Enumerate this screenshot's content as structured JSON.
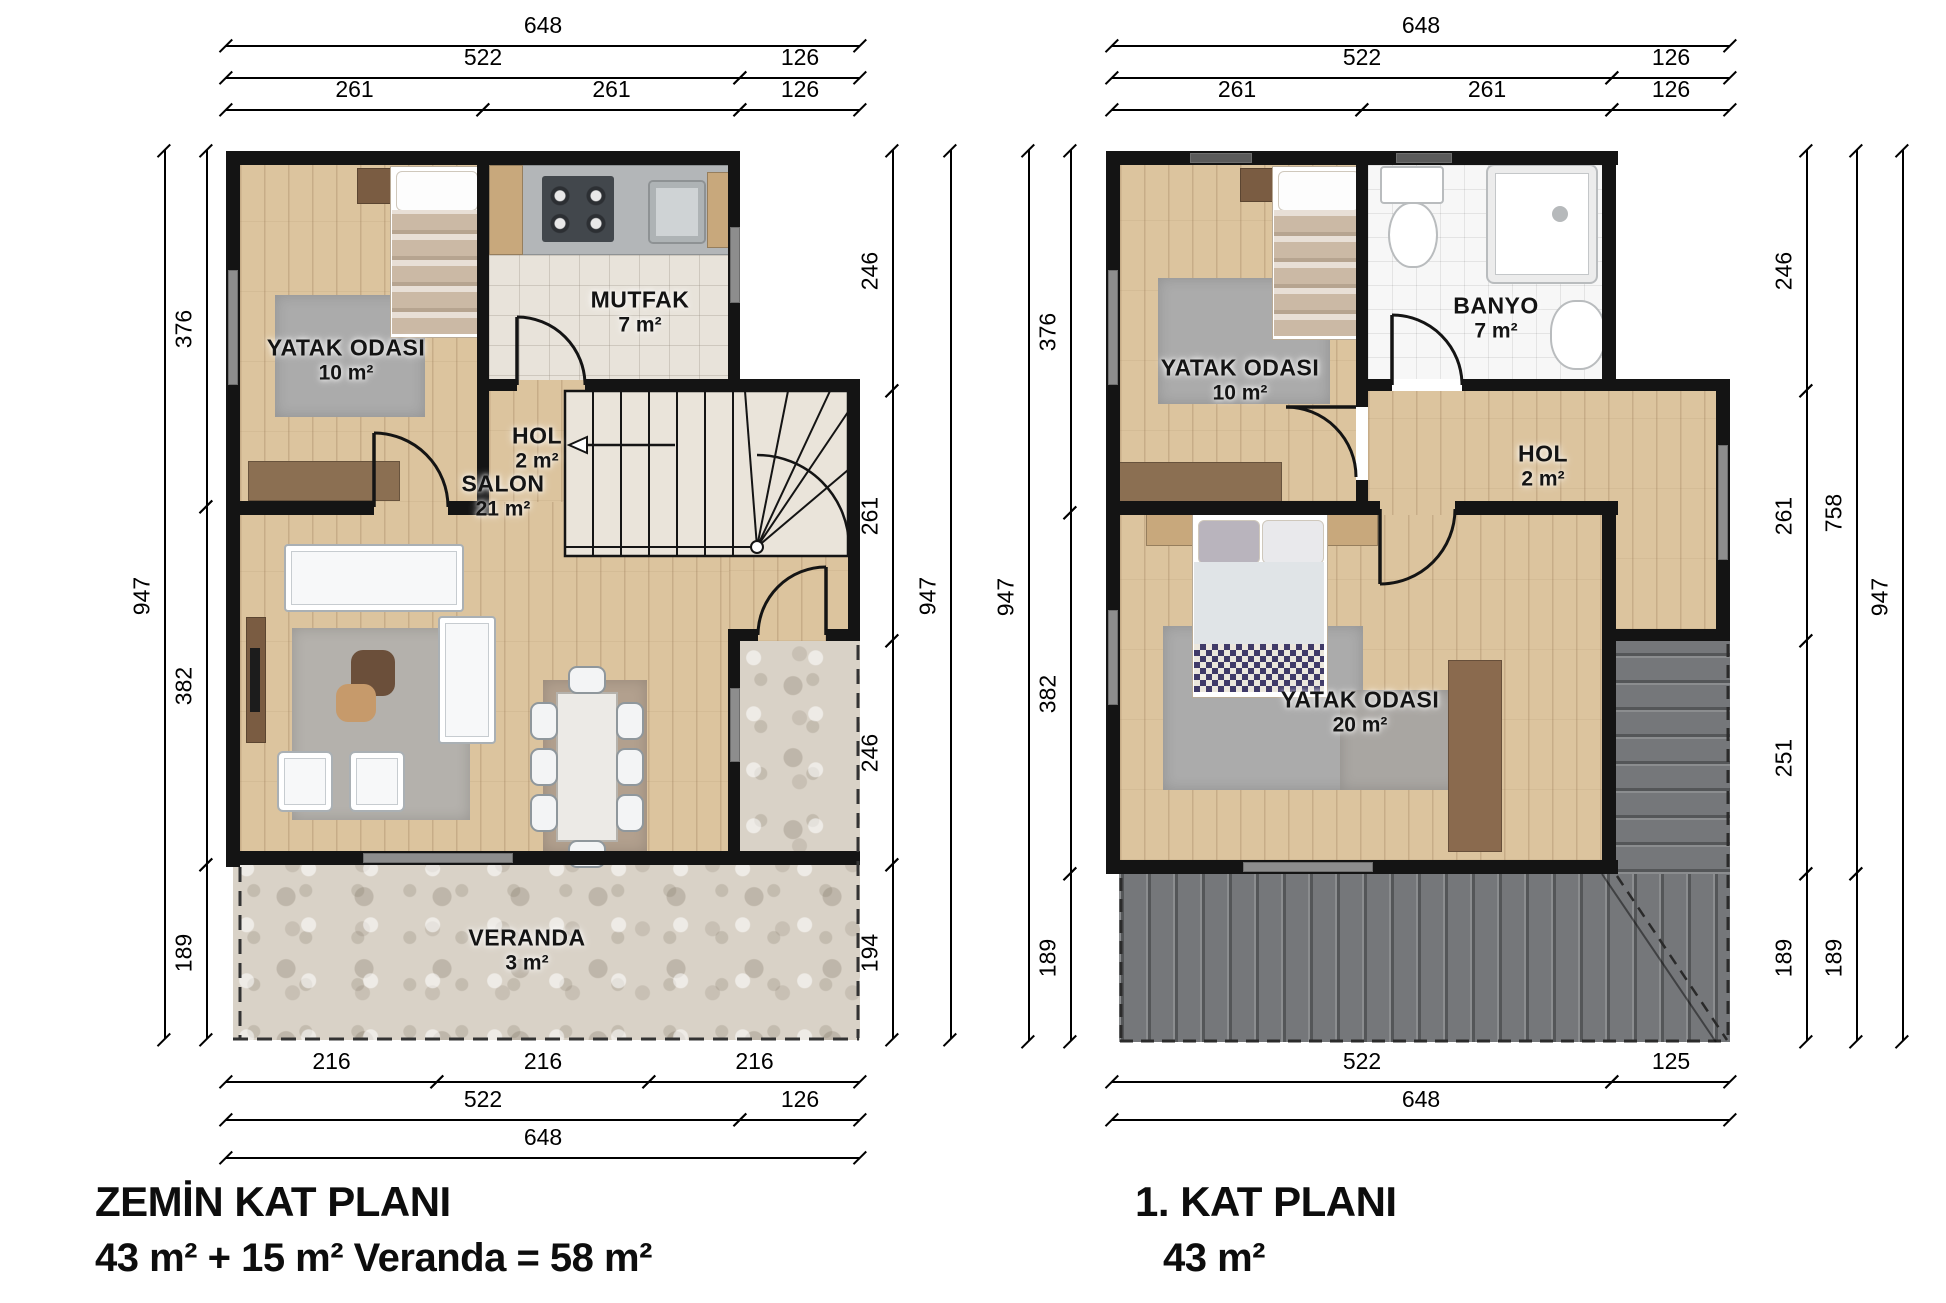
{
  "titles": {
    "plan1": {
      "line1": "ZEMİN KAT PLANI",
      "line2": "43 m² + 15 m² Veranda = 58 m²"
    },
    "plan2": {
      "line1": "1.  KAT PLANI",
      "line2": "43 m²"
    }
  },
  "rooms": [
    {
      "plan": 1,
      "name": "YATAK ODASI",
      "area": "10 m²",
      "x": 346,
      "y": 360
    },
    {
      "plan": 1,
      "name": "MUTFAK",
      "area": "7 m²",
      "x": 640,
      "y": 312
    },
    {
      "plan": 1,
      "name": "HOL",
      "area": "2 m²",
      "x": 537,
      "y": 448
    },
    {
      "plan": 1,
      "name": "SALON",
      "area": "21 m²",
      "x": 503,
      "y": 496
    },
    {
      "plan": 1,
      "name": "VERANDA",
      "area": "3 m²",
      "x": 527,
      "y": 950
    },
    {
      "plan": 2,
      "name": "YATAK ODASI",
      "area": "10 m²",
      "x": 1240,
      "y": 380
    },
    {
      "plan": 2,
      "name": "BANYO",
      "area": "7 m²",
      "x": 1496,
      "y": 318
    },
    {
      "plan": 2,
      "name": "HOL",
      "area": "2 m²",
      "x": 1543,
      "y": 466
    },
    {
      "plan": 2,
      "name": "YATAK ODASI",
      "area": "20 m²",
      "x": 1360,
      "y": 712
    }
  ],
  "dimensions": [
    {
      "label": "648",
      "o": "h",
      "x1": 226,
      "y1": 46,
      "x2": 860
    },
    {
      "label": "522",
      "o": "h",
      "x1": 226,
      "y1": 78,
      "x2": 740
    },
    {
      "label": "126",
      "o": "h",
      "x1": 740,
      "y1": 78,
      "x2": 860
    },
    {
      "label": "261",
      "o": "h",
      "x1": 226,
      "y1": 110,
      "x2": 483
    },
    {
      "label": "261",
      "o": "h",
      "x1": 483,
      "y1": 110,
      "x2": 740
    },
    {
      "label": "126",
      "o": "h",
      "x1": 740,
      "y1": 110,
      "x2": 860
    },
    {
      "label": "216",
      "o": "h",
      "x1": 226,
      "y1": 1082,
      "x2": 437
    },
    {
      "label": "216",
      "o": "h",
      "x1": 437,
      "y1": 1082,
      "x2": 649
    },
    {
      "label": "216",
      "o": "h",
      "x1": 649,
      "y1": 1082,
      "x2": 860
    },
    {
      "label": "522",
      "o": "h",
      "x1": 226,
      "y1": 1120,
      "x2": 740
    },
    {
      "label": "126",
      "o": "h",
      "x1": 740,
      "y1": 1120,
      "x2": 860
    },
    {
      "label": "648",
      "o": "h",
      "x1": 226,
      "y1": 1158,
      "x2": 860
    },
    {
      "label": "947",
      "o": "v",
      "x1": 164,
      "y1": 151,
      "y2": 1040
    },
    {
      "label": "376",
      "o": "v",
      "x1": 206,
      "y1": 151,
      "y2": 507
    },
    {
      "label": "382",
      "o": "v",
      "x1": 206,
      "y1": 507,
      "y2": 865
    },
    {
      "label": "189",
      "o": "v",
      "x1": 206,
      "y1": 865,
      "y2": 1040
    },
    {
      "label": "246",
      "o": "v",
      "x1": 892,
      "y1": 151,
      "y2": 391
    },
    {
      "label": "261",
      "o": "v",
      "x1": 892,
      "y1": 391,
      "y2": 641
    },
    {
      "label": "246",
      "o": "v",
      "x1": 892,
      "y1": 641,
      "y2": 865
    },
    {
      "label": "194",
      "o": "v",
      "x1": 892,
      "y1": 865,
      "y2": 1040
    },
    {
      "label": "947",
      "o": "v",
      "x1": 950,
      "y1": 151,
      "y2": 1040
    },
    {
      "label": "648",
      "o": "h",
      "x1": 1112,
      "y1": 46,
      "x2": 1730
    },
    {
      "label": "522",
      "o": "h",
      "x1": 1112,
      "y1": 78,
      "x2": 1612
    },
    {
      "label": "126",
      "o": "h",
      "x1": 1612,
      "y1": 78,
      "x2": 1730
    },
    {
      "label": "261",
      "o": "h",
      "x1": 1112,
      "y1": 110,
      "x2": 1362
    },
    {
      "label": "261",
      "o": "h",
      "x1": 1362,
      "y1": 110,
      "x2": 1612
    },
    {
      "label": "126",
      "o": "h",
      "x1": 1612,
      "y1": 110,
      "x2": 1730
    },
    {
      "label": "522",
      "o": "h",
      "x1": 1112,
      "y1": 1082,
      "x2": 1612
    },
    {
      "label": "125",
      "o": "h",
      "x1": 1612,
      "y1": 1082,
      "x2": 1730
    },
    {
      "label": "648",
      "o": "h",
      "x1": 1112,
      "y1": 1120,
      "x2": 1730
    },
    {
      "label": "947",
      "o": "v",
      "x1": 1028,
      "y1": 151,
      "y2": 1042
    },
    {
      "label": "376",
      "o": "v",
      "x1": 1070,
      "y1": 151,
      "y2": 513
    },
    {
      "label": "382",
      "o": "v",
      "x1": 1070,
      "y1": 513,
      "y2": 874
    },
    {
      "label": "189",
      "o": "v",
      "x1": 1070,
      "y1": 874,
      "y2": 1042
    },
    {
      "label": "246",
      "o": "v",
      "x1": 1806,
      "y1": 151,
      "y2": 391
    },
    {
      "label": "261",
      "o": "v",
      "x1": 1806,
      "y1": 391,
      "y2": 641
    },
    {
      "label": "251",
      "o": "v",
      "x1": 1806,
      "y1": 641,
      "y2": 874
    },
    {
      "label": "189",
      "o": "v",
      "x1": 1806,
      "y1": 874,
      "y2": 1042
    },
    {
      "label": "758",
      "o": "v",
      "x1": 1856,
      "y1": 151,
      "y2": 874
    },
    {
      "label": "189",
      "o": "v",
      "x1": 1856,
      "y1": 874,
      "y2": 1042
    },
    {
      "label": "947",
      "o": "v",
      "x1": 1902,
      "y1": 151,
      "y2": 1042
    }
  ],
  "colors": {
    "wall": "#141414",
    "wood_floor": "#dcc49e",
    "stone_veranda": "#d9d2c7",
    "roof": "#75777a",
    "window": "#8d8d8d",
    "kitchen_tile": "#e8e3da",
    "bath_tile": "#f7f7f7"
  }
}
